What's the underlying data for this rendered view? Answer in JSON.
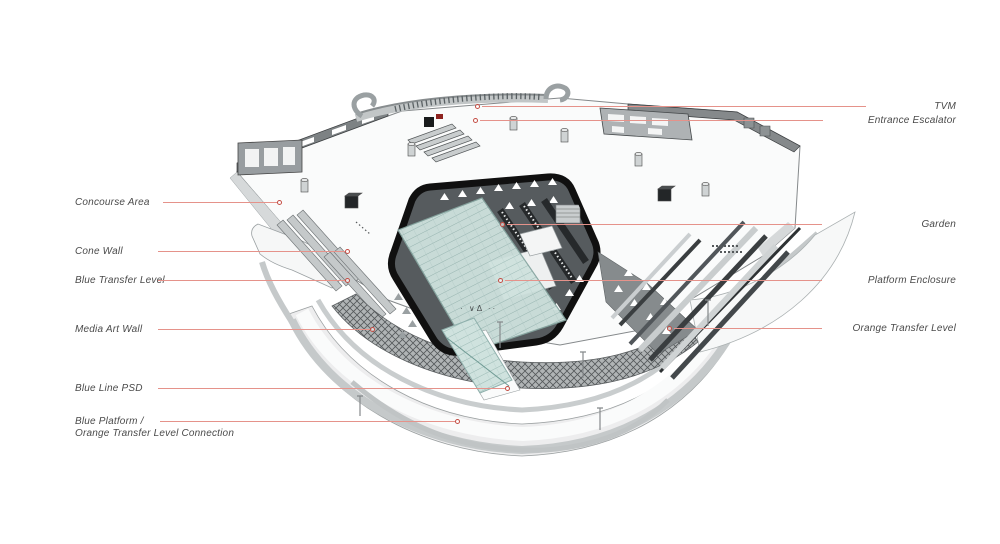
{
  "diagram": {
    "subject": "metro-station-axonometric-cutaway",
    "logo_marks": "· ∨Δ ··",
    "colors": {
      "leader_line": "#e5928a",
      "marker": "#c44d44",
      "label_text": "#4a4a4a",
      "glass": "#cfe2de",
      "ring": "#101010",
      "structure": "#c5c9ca"
    }
  },
  "annotations": {
    "left": [
      {
        "label": "Concourse Area"
      },
      {
        "label": "Cone Wall"
      },
      {
        "label": "Blue Transfer Level"
      },
      {
        "label": "Media Art Wall"
      },
      {
        "label": "Blue Line PSD"
      },
      {
        "lines": [
          "Blue Platform /",
          "Orange Transfer Level Connection"
        ]
      }
    ],
    "right": [
      {
        "label": "TVM"
      },
      {
        "label": "Entrance Escalator"
      },
      {
        "label": "Garden"
      },
      {
        "label": "Platform Enclosure"
      },
      {
        "label": "Orange Transfer Level"
      }
    ]
  }
}
